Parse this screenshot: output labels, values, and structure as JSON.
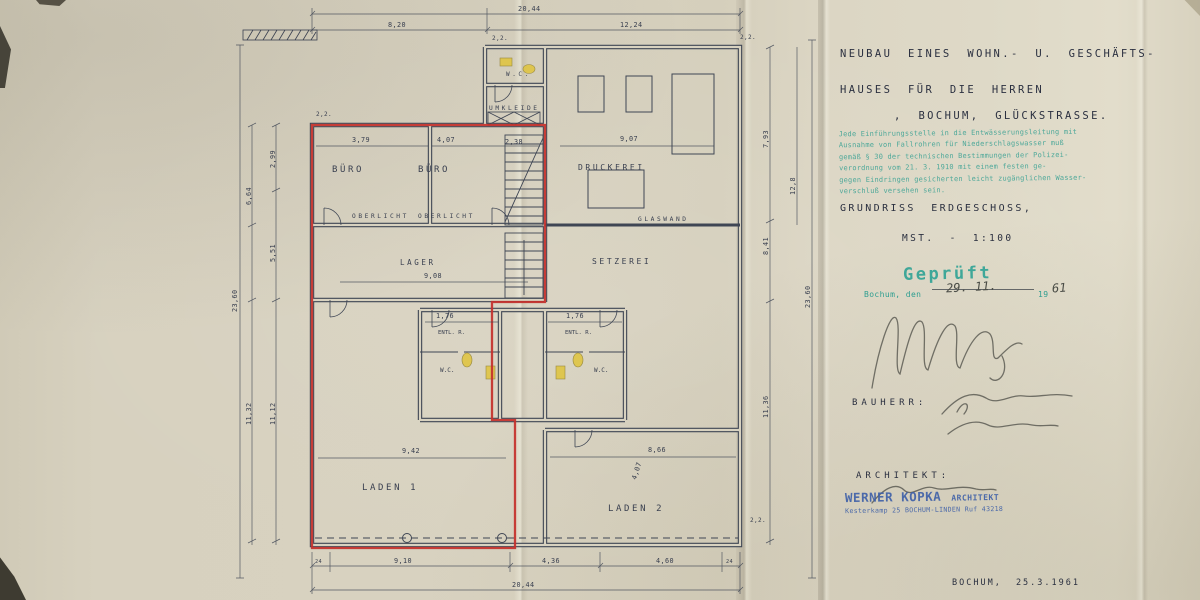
{
  "title_block": {
    "line1": "NEUBAU EINES WOHN.- U. GESCHÄFTS-",
    "line2": "HAUSES FÜR DIE HERREN",
    "line3": ", BOCHUM, GLÜCKSTRASSE."
  },
  "note_stamp": {
    "l1": "Jede Einführungsstelle in die Entwässerungsleitung mit",
    "l2": "Ausnahme von Fallrohren für Niederschlagswasser muß",
    "l3": "gemäß § 30 der technischen Bestimmungen der Polizei-",
    "l4": "verordnung vom 21. 3. 1910 mit einem festen ge-",
    "l5": "gegen Eindringen gesicherten leicht zugänglichen Wasser-",
    "l6": "verschluß versehen sein."
  },
  "drawing": {
    "title": "GRUNDRISS ERDGESCHOSS,",
    "scale": "MST. - 1:100"
  },
  "approval": {
    "stamp": "Geprüft",
    "place_line": "Bochum, den",
    "date_hand": "29. 11.",
    "year_print": "19",
    "year_hand": "61"
  },
  "parties": {
    "bauherr_label": "BAUHERR:",
    "architekt_label": "ARCHITEKT:",
    "stamp_name": "WERNER KOPKA",
    "stamp_title": "ARCHITEKT",
    "stamp_addr": "Kesterkamp 25    BOCHUM-LINDEN    Ruf 43218"
  },
  "footer": {
    "place_date": "BOCHUM, 25.3.1961"
  },
  "plan": {
    "rooms": {
      "buero1": "BÜRO",
      "buero2": "BÜRO",
      "oberlicht": "OBERLICHT",
      "lager": "LAGER",
      "druckerei": "DRUCKEREI",
      "setzerei": "SETZEREI",
      "glaswand": "GLASWAND",
      "umkleide": "UMKLEIDE",
      "wc": "W.C.",
      "entl": "ENTL. R.",
      "laden1": "LADEN 1",
      "laden2": "LADEN 2"
    },
    "dims": {
      "total_w": "20,44",
      "top_a": "8,20",
      "top_b": "12,24",
      "bot_a": "9,10",
      "bot_b": "4,36",
      "bot_c": "4,60",
      "side_total": "23,60",
      "left_a": "6,64",
      "left_b": "11,32",
      "left_c": "2,99",
      "left_d": "5,51",
      "left_e": "11,12",
      "right_a": "7,93",
      "right_b": "8,41",
      "right_c": "11,36",
      "right_d": "12,8",
      "buero1_w": "3,79",
      "buero2_w": "4,07",
      "flur": "2,38",
      "lager_w": "9,08",
      "druck_w": "9,07",
      "laden1_w": "9,42",
      "laden2_w": "8,66",
      "laden2_d": "4,07",
      "wc_w": "1,76",
      "corner": "2,2.",
      "end24": "24"
    }
  },
  "colors": {
    "paper": "#d8d2c0",
    "ink": "#3a4050",
    "red_outline": "#c4302b",
    "teal_stamp": "#2f9e90",
    "blue_stamp": "#3d5fa8",
    "pencil": "#55554e",
    "yellow_marker": "#e0c43c"
  }
}
